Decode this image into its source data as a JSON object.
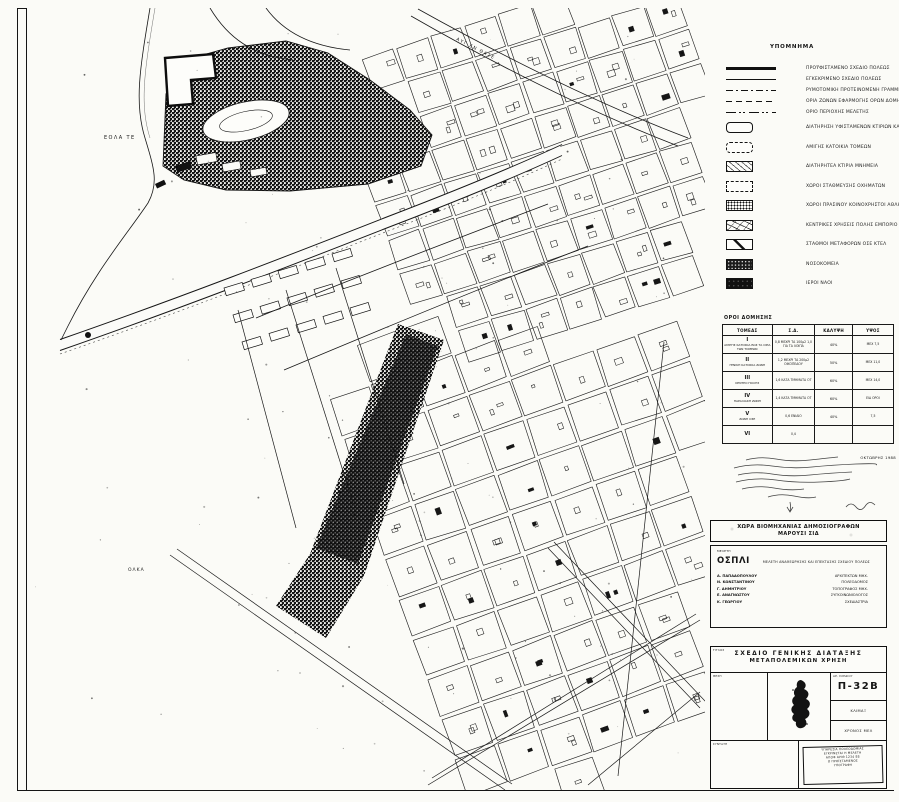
{
  "map": {
    "sea_label_top": "ΕΟΛΑ ΤΕ",
    "sea_label_bottom": "ΟΛΚΑ",
    "street_label": "ΑΥΓ ΕΝ ΘΑΣΕ"
  },
  "legend": {
    "title": "ΥΠΟΜΝΗΜΑ",
    "items": [
      {
        "kind": "line",
        "symbol": "sym-hline-bold",
        "label": "ΠΡΟΫΦΙΣΤΑΜΕΝΟ ΣΧΕΔΙΟ ΠΟΛΕΩΣ"
      },
      {
        "kind": "line",
        "symbol": "sym-hline-thin",
        "label": "ΕΓΚΕΚΡΙΜΕΝΟ ΣΧΕΔΙΟ ΠΟΛΕΩΣ"
      },
      {
        "kind": "line",
        "symbol": "sym-dashdot",
        "label": "ΡΥΜΟΤΟΜΙΚΗ ΠΡΟΤΕΙΝΟΜΕΝΗ ΓΡΑΜΜΗ"
      },
      {
        "kind": "line",
        "symbol": "sym-dashed",
        "label": "ΟΡΙΑ ΖΩΝΩΝ ΕΦΑΡΜΟΓΗΣ ΟΡΩΝ ΔΟΜΗΣΗΣ"
      },
      {
        "kind": "line",
        "symbol": "sym-dashdd",
        "label": "ΟΡΙΟ ΠΕΡΙΟΧΗΣ ΜΕΛΕΤΗΣ"
      },
      {
        "kind": "box",
        "symbol": "sym-box-round",
        "label": "ΔΙΑΤΗΡΗΣΗ ΥΦΙΣΤΑΜΕΝΩΝ ΚΤΙΡΙΩΝ ΚΑΙ ΧΡΗΣΕΩΝ"
      },
      {
        "kind": "box",
        "symbol": "sym-box-round-dash",
        "label": "ΑΜΙΓΗΣ ΚΑΤΟΙΚΙΑ ΤΟΜΕΩΝ"
      },
      {
        "kind": "box",
        "symbol": "sym-box-hatch",
        "label": "ΔΙΑΤΗΡΗΤΕΑ ΚΤΙΡΙΑ ΜΝΗΜΕΙΑ"
      },
      {
        "kind": "box",
        "symbol": "sym-box-dash",
        "label": "ΧΩΡΟΙ ΣΤΑΘΜΕΥΣΗΣ ΟΧΗΜΑΤΩΝ"
      },
      {
        "kind": "box",
        "symbol": "sym-box-stipple",
        "label": "ΧΩΡΟΙ ΠΡΑΣΙΝΟΥ ΚΟΙΝΟΧΡΗΣΤΟΙ  ΑΘΛΗΤΙΚΟΙ"
      },
      {
        "kind": "box",
        "symbol": "sym-box-scribble",
        "label": "ΚΕΝΤΡΙΚΕΣ ΧΡΗΣΕΙΣ ΠΟΛΗΣ ΕΜΠΟΡΙΟ ΓΡΑΦΕΙΑ"
      },
      {
        "kind": "box",
        "symbol": "sym-box-diag",
        "label": "ΣΤΑΘΜΟΙ ΜΕΤΑΦΟΡΩΝ ΟΣΕ  ΚΤΕΛ"
      },
      {
        "kind": "box",
        "symbol": "sym-box-darkstipple",
        "label": "ΝΟΣΟΚΟΜΕΙΑ"
      },
      {
        "kind": "box",
        "symbol": "sym-box-solid",
        "label": "ΙΕΡΟΙ ΝΑΟΙ"
      }
    ]
  },
  "terms_table": {
    "title": "ΟΡΟΙ ΔΟΜΗΣΗΣ",
    "columns": [
      "ΤΟΜΕΑΣ",
      "Σ.Δ.",
      "ΚΑΛΥΨΗ",
      "ΥΨΟΣ"
    ],
    "rows": [
      {
        "sector": "Ι",
        "sector_note": "ΑΜΙΓΗΣ ΚΑΤΟΙΚΙΑ ΕΩΣ ΤΑ ΟΡΙΑ ΤΩΝ ΤΟΜΕΩΝ",
        "sd": "0,8 ΜΕΧΡΙ ΤΑ 100μ2 1,0 ΓΙΑ ΤΑ ΛΟΙΠΑ",
        "coverage": "40%",
        "height": "ΜΕΧ 7,5"
      },
      {
        "sector": "ΙΙ",
        "sector_note": "ΓΕΝΙΚΗ ΚΑΤΟΙΚΙΑ ΖΩΝΗ",
        "sd": "1,2 ΜΕΧΡΙ ΤΑ 200μ2 ΟΙΚΟΠΕΔΟΥ",
        "coverage": "50%",
        "height": "ΜΕΧ 11,0"
      },
      {
        "sector": "ΙΙΙ",
        "sector_note": "ΚΕΝΤΡΟ ΠΟΛΗΣ",
        "sd": "1,6 ΚΑΤΑ ΤΜΗΜΑΤΑ ΟΤ",
        "coverage": "60%",
        "height": "ΜΕΧ 14,0"
      },
      {
        "sector": "ΙV",
        "sector_note": "ΠΑΡΑΛΙΑΚΗ ΖΩΝΗ",
        "sd": "1,4 ΚΑΤΑ ΤΜΗΜΑΤΑ ΟΤ",
        "coverage": "60%",
        "height": "ΕΙΔ ΟΡΟΙ"
      },
      {
        "sector": "V",
        "sector_note": "ΖΩΝΗ ΟΣΕ",
        "sd": "0,6 ΕΝΙΑΙΟ",
        "coverage": "40%",
        "height": "7,5"
      },
      {
        "sector": "VΙ",
        "sector_note": "",
        "sd": "0,4",
        "coverage": "",
        "height": ""
      }
    ],
    "note_date": "ΟΚΤΩΒΡΗΣ 1988"
  },
  "agency_block": {
    "header_line1": "ΧΩΡΑ ΒΙΟΜΗΧΑΝΙΑΣ ΔΗΜΟΣΙΟΓΡΑΦΩΝ",
    "header_line2": "ΜΑΡΟΥΣΙ ΣΙΔ",
    "corner_note": "ΜΕΛΕΤΗ",
    "org": "ΟΣΠΛΙ",
    "subtitle": "ΜΕΛΕΤΗ ΑΝΑΘΕΩΡΗΣΗΣ ΚΑΙ ΕΠΕΚΤΑΣΗΣ ΣΧΕΔΙΟΥ ΠΟΛΕΩΣ",
    "personnel": [
      {
        "name": "Α. ΠΑΠΑΔΟΠΟΥΛΟΥ",
        "role": "ΑΡΧΙΤΕΚΤΩΝ ΜΗΧ."
      },
      {
        "name": "Ν. ΚΩΝΣΤΑΝΤΙΝΟΥ",
        "role": "ΠΟΛΕΟΔΟΜΟΣ"
      },
      {
        "name": "Γ. ΔΗΜΗΤΡΙΟΥ",
        "role": "ΤΟΠΟΓΡΑΦΟΣ ΜΗΧ."
      },
      {
        "name": "Ε. ΑΝΑΓΝΩΣΤΟΥ",
        "role": "ΣΥΓΚΟΙΝΩΝΙΟΛΟΓΟΣ"
      },
      {
        "name": "Κ. ΓΕΩΡΓΙΟΥ",
        "role": "ΣΧΕΔΙΑΣΤΡΙΑ"
      }
    ]
  },
  "drawing_block": {
    "title_line1": "ΣΧΕΔΙΟ ΓΕΝΙΚΗΣ ΔΙΑΤΑΞΗΣ",
    "title_line2": "ΜΕΤΑΠΟΛΕΜΙΚΩΝ ΧΡΗΣΗ",
    "sheet_number": "Π-32Β",
    "labels": {
      "title": "ΤΙΤΛΟΣ",
      "location": "ΘΕΣΗ",
      "number": "ΑΡ. ΣΧΕΔΙΟΥ",
      "scale": "ΚΛΙΜΑΞ",
      "date": "ΧΡΟΝΟΣ ΜΕΛ",
      "prepared": "ΣΥΝΤΑΞΗ"
    },
    "stamp_lines": [
      "ΥΠΗΡΕΣΙΑ ΠΟΛΕΟΔΟΜΙΑΣ",
      "ΕΓΚΡΙΝΕΤΑΙ Η ΜΕΛΕΤΗ",
      "ΑΠΟΦ ΑΡΙΘ 1234 88",
      "Ο ΠΡΟΪΣΤΑΜΕΝΟΣ",
      "ΥΠΟΓΡΑΦΗ"
    ]
  }
}
